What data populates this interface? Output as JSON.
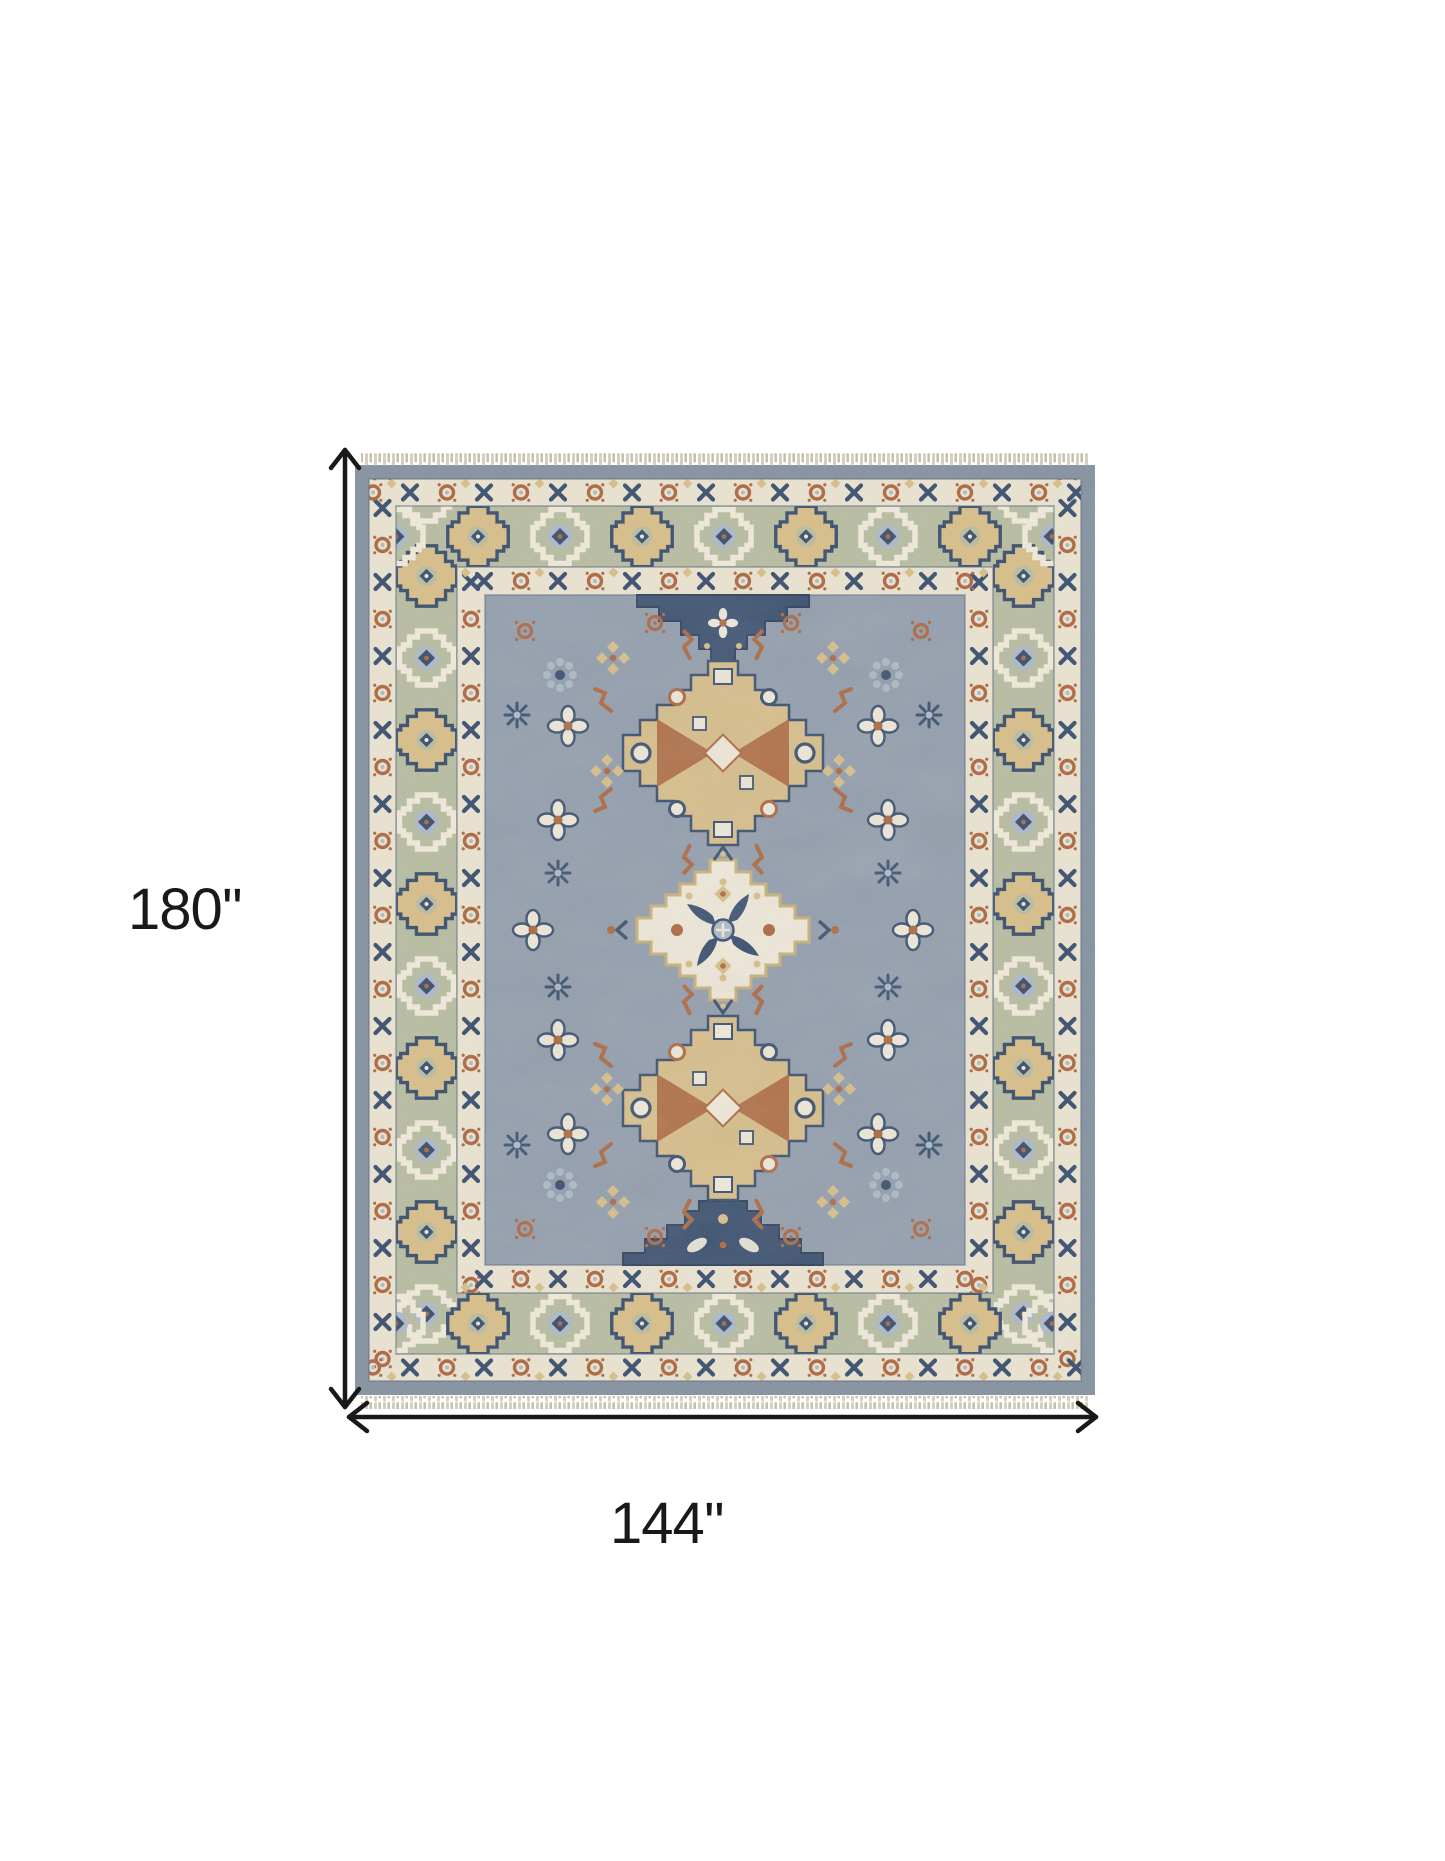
{
  "alt": "Top view of a hand-knotted oriental medallion area rug annotated with dimension arrows",
  "dimensions": {
    "height_label": "180''",
    "width_label": "144''"
  },
  "icons": {
    "height_arrow": "double-headed-vertical-arrow-icon",
    "width_arrow": "double-headed-horizontal-arrow-icon"
  },
  "colors": {
    "page_bg": "#ffffff",
    "annotation": "#191919",
    "field": "#949fae",
    "selvedge": "#8793a2",
    "band_cream": "#eae3d1",
    "band_sage": "#b8bda2",
    "cream": "#efe9d9",
    "navy": "#3d5271",
    "navy_dark": "#32435f",
    "rust": "#ae6a43",
    "gold": "#d8bf8b",
    "gold_dark": "#c9b279",
    "gray_blue_light": "#aebac6",
    "guard": "#5c6c85",
    "fringe": "#d6cfc0",
    "fringe_dark": "#c8c0ad"
  }
}
